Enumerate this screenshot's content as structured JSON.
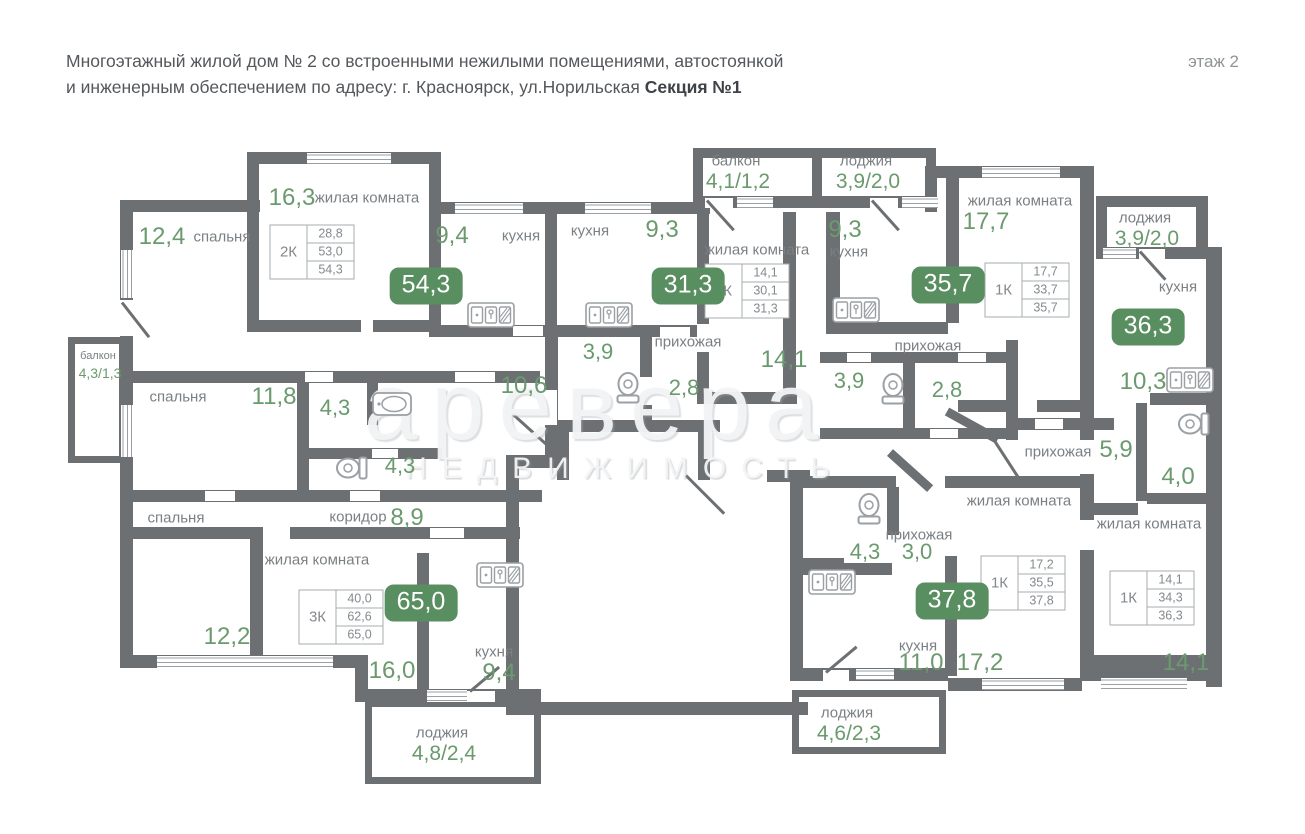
{
  "header": {
    "line1": "Многоэтажный жилой дом № 2 со встроенными нежилыми помещениями, автостоянкой",
    "line2": "и инженерным обеспечением по адресу: г. Красноярск, ул.Норильская ",
    "line2_bold": "Секция №1",
    "floor": "этаж 2"
  },
  "watermark": {
    "big": "аревера",
    "small": "НЕДВИЖИМОСТЬ"
  },
  "colors": {
    "wall": "#6d7072",
    "green": "#6a9a6e",
    "badge_bg": "#588e60",
    "label_gray": "#7b8084",
    "icon_line": "#9aa0a4"
  },
  "badges": [
    {
      "value": "54,3",
      "x": 426,
      "y": 286
    },
    {
      "value": "31,3",
      "x": 688,
      "y": 286
    },
    {
      "value": "35,7",
      "x": 948,
      "y": 285
    },
    {
      "value": "36,3",
      "x": 1148,
      "y": 327
    },
    {
      "value": "65,0",
      "x": 421,
      "y": 603
    },
    {
      "value": "37,8",
      "x": 952,
      "y": 601
    }
  ],
  "apartment_tables": [
    {
      "type": "2К",
      "rows": [
        "28,8",
        "53,0",
        "54,3"
      ],
      "x": 312,
      "y": 252
    },
    {
      "type": "1К",
      "rows": [
        "14,1",
        "30,1",
        "31,3"
      ],
      "x": 747,
      "y": 291
    },
    {
      "type": "1К",
      "rows": [
        "17,7",
        "33,7",
        "35,7"
      ],
      "x": 1027,
      "y": 290
    },
    {
      "type": "3К",
      "rows": [
        "40,0",
        "62,6",
        "65,0"
      ],
      "x": 341,
      "y": 617
    },
    {
      "type": "1К",
      "rows": [
        "17,2",
        "35,5",
        "37,8"
      ],
      "x": 1023,
      "y": 583
    },
    {
      "type": "1К",
      "rows": [
        "14,1",
        "34,3",
        "36,3"
      ],
      "x": 1152,
      "y": 598
    }
  ],
  "area_numbers": [
    {
      "text": "12,4",
      "x": 162,
      "y": 237,
      "fs": 24
    },
    {
      "text": "16,3",
      "x": 292,
      "y": 198,
      "fs": 24
    },
    {
      "text": "9,4",
      "x": 452,
      "y": 236,
      "fs": 24
    },
    {
      "text": "9,3",
      "x": 662,
      "y": 230,
      "fs": 24
    },
    {
      "text": "9,3",
      "x": 845,
      "y": 230,
      "fs": 24
    },
    {
      "text": "17,7",
      "x": 986,
      "y": 222,
      "fs": 24
    },
    {
      "text": "10,6",
      "x": 524,
      "y": 386,
      "fs": 24
    },
    {
      "text": "3,9",
      "x": 598,
      "y": 352,
      "fs": 22
    },
    {
      "text": "2,8",
      "x": 684,
      "y": 388,
      "fs": 22
    },
    {
      "text": "14,1",
      "x": 784,
      "y": 360,
      "fs": 24
    },
    {
      "text": "3,9",
      "x": 849,
      "y": 381,
      "fs": 22
    },
    {
      "text": "2,8",
      "x": 947,
      "y": 390,
      "fs": 22
    },
    {
      "text": "4,3",
      "x": 335,
      "y": 408,
      "fs": 22
    },
    {
      "text": "4,3",
      "x": 400,
      "y": 466,
      "fs": 22
    },
    {
      "text": "11,8",
      "x": 274,
      "y": 397,
      "fs": 24
    },
    {
      "text": "8,9",
      "x": 407,
      "y": 518,
      "fs": 24
    },
    {
      "text": "12,2",
      "x": 227,
      "y": 637,
      "fs": 24
    },
    {
      "text": "16,0",
      "x": 392,
      "y": 671,
      "fs": 24
    },
    {
      "text": "9,4",
      "x": 499,
      "y": 673,
      "fs": 24
    },
    {
      "text": "10,3",
      "x": 1143,
      "y": 382,
      "fs": 24
    },
    {
      "text": "5,9",
      "x": 1116,
      "y": 450,
      "fs": 24
    },
    {
      "text": "4,0",
      "x": 1178,
      "y": 477,
      "fs": 24
    },
    {
      "text": "14,1",
      "x": 1186,
      "y": 663,
      "fs": 24
    },
    {
      "text": "4,3",
      "x": 865,
      "y": 552,
      "fs": 22
    },
    {
      "text": "3,0",
      "x": 917,
      "y": 552,
      "fs": 22
    },
    {
      "text": "11,0",
      "x": 921,
      "y": 663,
      "fs": 24
    },
    {
      "text": "17,2",
      "x": 980,
      "y": 663,
      "fs": 24
    }
  ],
  "room_labels": [
    {
      "text": "спальня",
      "x": 222,
      "y": 237
    },
    {
      "text": "жилая комната",
      "x": 367,
      "y": 198
    },
    {
      "text": "кухня",
      "x": 521,
      "y": 236
    },
    {
      "text": "кухня",
      "x": 590,
      "y": 231
    },
    {
      "text": "жилая комната",
      "x": 757,
      "y": 250
    },
    {
      "text": "прихожая",
      "x": 688,
      "y": 342
    },
    {
      "text": "кухня",
      "x": 849,
      "y": 252
    },
    {
      "text": "жилая комната",
      "x": 1020,
      "y": 201
    },
    {
      "text": "прихожая",
      "x": 928,
      "y": 346
    },
    {
      "text": "кухня",
      "x": 1178,
      "y": 287
    },
    {
      "text": "прихожая",
      "x": 1058,
      "y": 452
    },
    {
      "text": "жилая комната",
      "x": 1149,
      "y": 524
    },
    {
      "text": "спальня",
      "x": 178,
      "y": 397
    },
    {
      "text": "спальня",
      "x": 176,
      "y": 518
    },
    {
      "text": "коридор",
      "x": 358,
      "y": 517
    },
    {
      "text": "жилая комната",
      "x": 317,
      "y": 560
    },
    {
      "text": "кухня",
      "x": 494,
      "y": 652
    },
    {
      "text": "прихожая",
      "x": 919,
      "y": 535
    },
    {
      "text": "жилая комната",
      "x": 1019,
      "y": 501
    },
    {
      "text": "кухня",
      "x": 918,
      "y": 646
    }
  ],
  "balconies": [
    {
      "name": "балкон",
      "value": "4,3/1,3",
      "x": 98,
      "y": 356,
      "nfs": 11,
      "vfs": 14
    },
    {
      "name": "балкон",
      "value": "4,1/1,2",
      "x": 736,
      "y": 161,
      "nfs": 15,
      "vfs": 21
    },
    {
      "name": "лоджия",
      "value": "3,9/2,0",
      "x": 866,
      "y": 161,
      "nfs": 15,
      "vfs": 21
    },
    {
      "name": "лоджия",
      "value": "3,9/2,0",
      "x": 1145,
      "y": 218,
      "nfs": 15,
      "vfs": 21
    },
    {
      "name": "лоджия",
      "value": "4,8/2,4",
      "x": 442,
      "y": 733,
      "nfs": 15,
      "vfs": 21
    },
    {
      "name": "лоджия",
      "value": "4,6/2,3",
      "x": 847,
      "y": 713,
      "nfs": 15,
      "vfs": 21
    }
  ],
  "icons": {
    "toilets": [
      {
        "x": 628,
        "y": 388,
        "rot": 90
      },
      {
        "x": 893,
        "y": 389,
        "rot": 90
      },
      {
        "x": 352,
        "y": 468,
        "rot": 0
      },
      {
        "x": 869,
        "y": 509,
        "rot": 90
      },
      {
        "x": 1194,
        "y": 424,
        "rot": 0
      }
    ],
    "kitchen_sinks": [
      {
        "x": 491,
        "y": 315
      },
      {
        "x": 609,
        "y": 315
      },
      {
        "x": 856,
        "y": 310
      },
      {
        "x": 1190,
        "y": 380
      },
      {
        "x": 500,
        "y": 575
      },
      {
        "x": 832,
        "y": 582
      }
    ],
    "washbasins": [
      {
        "x": 392,
        "y": 404
      }
    ]
  }
}
